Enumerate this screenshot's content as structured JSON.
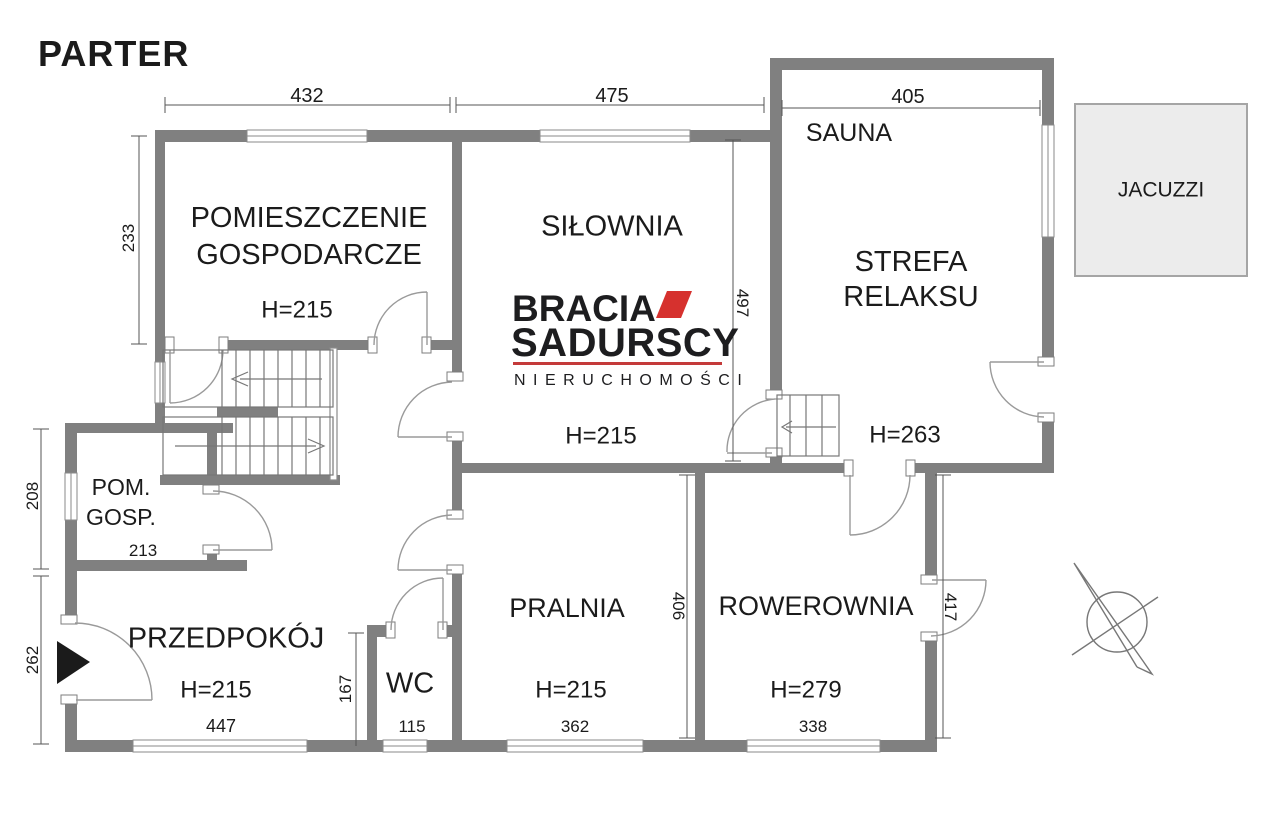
{
  "title": "PARTER",
  "logo": {
    "brand_line1": "BRACIA",
    "brand_line2": "SADURSCY",
    "tagline": "NIERUCHOMOŚCI"
  },
  "colors": {
    "wall": "#808080",
    "accent_red": "#d6312e",
    "text": "#1b1b1b",
    "jacuzzi_fill": "#ececec"
  },
  "rooms": {
    "gospodarcze": {
      "line1": "POMIESZCZENIE",
      "line2": "GOSPODARCZE",
      "height": "H=215"
    },
    "silownia": {
      "name": "SIŁOWNIA",
      "height": "H=215"
    },
    "sauna": {
      "name": "SAUNA"
    },
    "strefa": {
      "line1": "STREFA",
      "line2": "RELAKSU",
      "height": "H=263"
    },
    "jacuzzi": {
      "name": "JACUZZI"
    },
    "pomgosp": {
      "line1": "POM.",
      "line2": "GOSP."
    },
    "przedpokoj": {
      "name": "PRZEDPOKÓJ",
      "height": "H=215"
    },
    "wc": {
      "name": "WC"
    },
    "pralnia": {
      "name": "PRALNIA",
      "height": "H=215"
    },
    "rowerownia": {
      "name": "ROWEROWNIA",
      "height": "H=279"
    }
  },
  "dimensions": {
    "top_432": "432",
    "top_475": "475",
    "top_405": "405",
    "left_233": "233",
    "left_208": "208",
    "left_262": "262",
    "mid_497": "497",
    "mid_406": "406",
    "right_417": "417",
    "wc_167": "167",
    "pomgosp_213": "213",
    "przedpokoj_447": "447",
    "wc_115": "115",
    "pralnia_362": "362",
    "rowerownia_338": "338"
  }
}
